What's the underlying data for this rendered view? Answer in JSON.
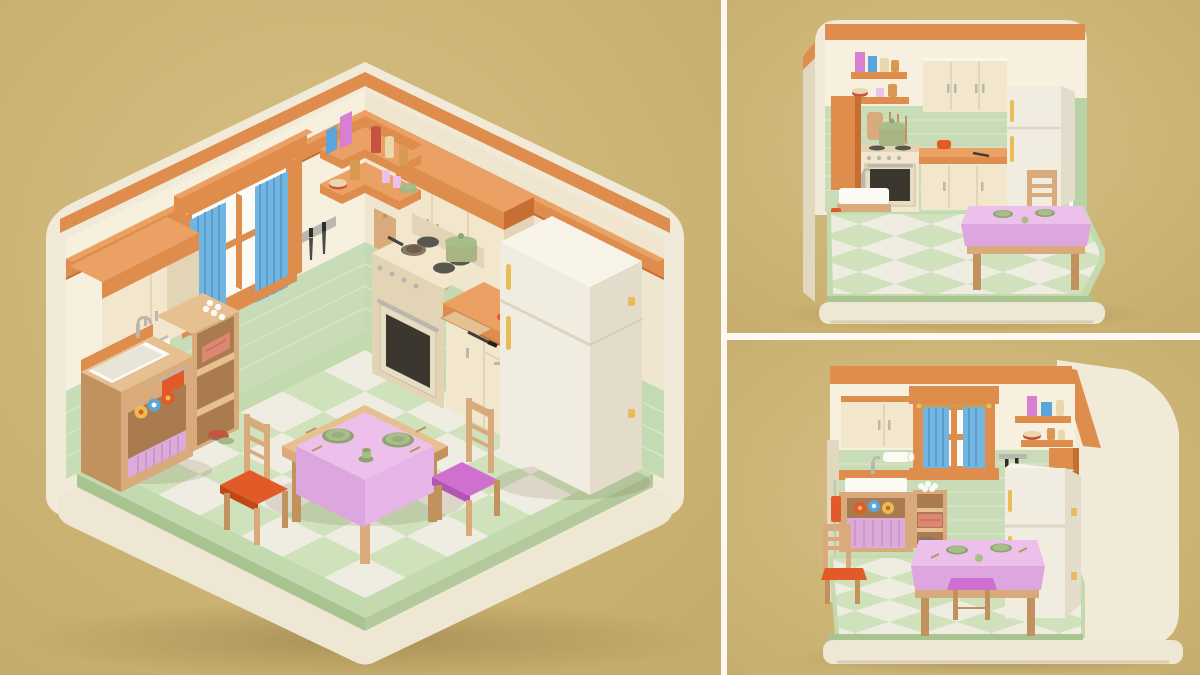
{
  "artwork": {
    "type": "3d-render-triptych",
    "subject": "Miniature isometric kitchen diorama, pastel clay-style 3D illustration",
    "background": "plain tan studio backdrop",
    "text_visible": false
  },
  "panels": [
    {
      "id": "main-isometric-view",
      "aria": "Large isometric corner view of a miniature kitchen: cream walls with orange trim, mint tile wainscot, window with blue curtains, stove, orange counter, fridge, sink cabinet, shelf unit, corner shelves and a dining table with pink tablecloth and two chairs on a green checkered floor",
      "objects": [
        "wall-trim",
        "window",
        "blue-curtains",
        "upper-cabinet-left",
        "upper-cabinet-right",
        "corner-shelves",
        "jars-and-books",
        "knife-strip",
        "cutting-board",
        "hanging-utensils",
        "stove",
        "green-pot",
        "frying-pan",
        "counter",
        "orange-bowl",
        "kitchen-knife",
        "fridge",
        "sink-cabinet",
        "orange-towel",
        "rolled-towels",
        "under-sink-curtain",
        "paper-towel-roll",
        "shelf-unit",
        "egg-tray",
        "pink-crate",
        "bowls",
        "dining-table",
        "pink-tablecloth",
        "green-plates",
        "teacup",
        "chair-orange-cushion",
        "chair-purple-cushion",
        "checkered-floor",
        "base-platform"
      ]
    },
    {
      "id": "front-elevation-view",
      "aria": "Smaller front view of the same miniature kitchen seen straight on: corner shelves, orange pantry, stove with green pot, upper cabinets, orange counter, fridge and dining table with chair",
      "objects": [
        "wall-trim",
        "corner-shelves",
        "orange-pantry",
        "cutting-board",
        "hanging-utensils",
        "stove",
        "green-pot",
        "upper-cabinet",
        "counter",
        "orange-bowl",
        "fridge",
        "sink",
        "dining-table",
        "chair",
        "checkered-floor",
        "base-platform"
      ]
    },
    {
      "id": "window-wall-view",
      "aria": "Smaller three-quarter view facing the window wall: upper cabinet, window with blue curtains, corner shelves, orange pantry, knife strip, sink cabinet with pink curtain, shelf unit, fridge in front and dining table with orange and purple cushioned chairs",
      "objects": [
        "wall-trim",
        "upper-cabinet",
        "window",
        "blue-curtains",
        "corner-shelves",
        "orange-pantry",
        "knife-strip",
        "paper-towel-roll",
        "sink-cabinet",
        "red-towel",
        "rolled-towels",
        "under-sink-curtain",
        "shelf-unit",
        "egg-tray",
        "pink-crate",
        "fridge",
        "dining-table",
        "pink-tablecloth",
        "green-plates",
        "chair-orange-cushion",
        "stool-purple-cushion",
        "checkered-floor",
        "base-platform"
      ]
    }
  ],
  "palette": {
    "bg1": "#d7c084",
    "bg2": "#c4ab6a",
    "divider": "#fbf9f1",
    "slab": "#f1ead8",
    "slabEdge": "#e2d8bf",
    "wall": "#f7f0df",
    "wallSh": "#f0e6cf",
    "or": "#df8d4d",
    "orL": "#eba163",
    "orD": "#c76f33",
    "tile": "#c8ddb7",
    "tileSh": "#b9d2a6",
    "grout": "#d9e8cb",
    "mint": "#c3d9ae",
    "mintE": "#a9c391",
    "floorWhite": "#efece2",
    "floorGreen": "#cfe2bc",
    "base": "#eee7d4",
    "baseSh": "#d9cdb1",
    "wood": "#d9ab7c",
    "woodD": "#c2925e",
    "woodL": "#e6c091",
    "woodCav": "#aa7b4e",
    "cab": "#f2e6cd",
    "cabSh": "#e3d4b6",
    "fridge": "#f1ece0",
    "fridgeSh": "#e3dccb",
    "fridgeTop": "#f8f4ea",
    "oven": "#3b372e",
    "steel": "#b9b7ae",
    "burner": "#57564f",
    "blue": "#72b5e1",
    "blueD": "#4e95c7",
    "pink": "#ecc0eb",
    "pink2": "#e6b4e6",
    "pinkD": "#dda6de",
    "lilac": "#dcabda",
    "lilacD": "#c792c6",
    "orangeC": "#e25a28",
    "orangeCD": "#c14618",
    "purple": "#cf70d0",
    "purpleD": "#b455b6",
    "plate": "#a9bd8b",
    "plateD": "#8ea371",
    "pot": "#a8b482",
    "pan": "#8b7565",
    "white": "#fbfaf4",
    "yellow": "#e9bd55",
    "bookB": "#5ca5da",
    "bookP": "#d77fd0",
    "red": "#c6523f",
    "crate": "#dd8773",
    "amber": "#d89a52",
    "cream2": "#ead7ae",
    "rod": "#c9a050",
    "shadowC": "#4a3a14",
    "shadowSoft": "#755c29"
  }
}
